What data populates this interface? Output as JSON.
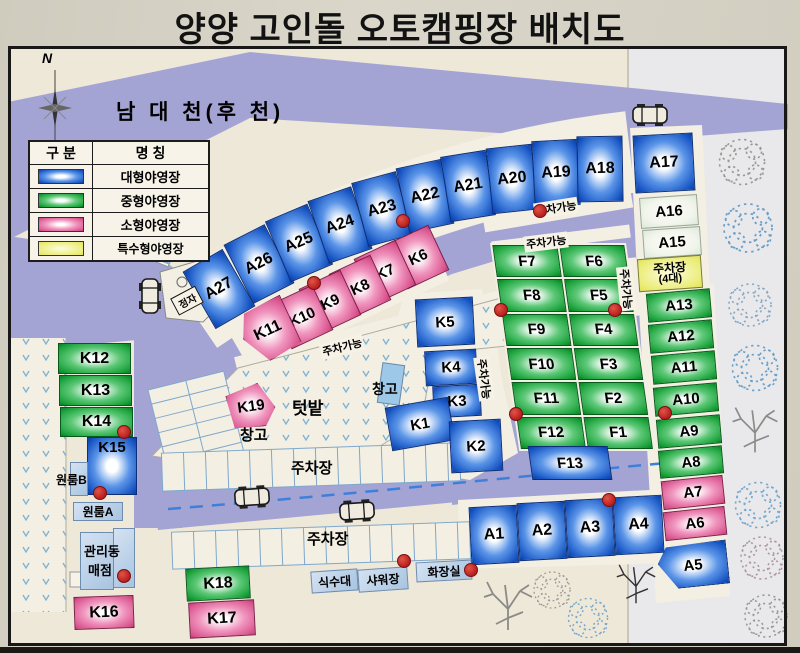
{
  "title": "양양 고인돌 오토캠핑장 배치도",
  "compass": "N",
  "river": "남 대 천(후 천)",
  "legend": {
    "col1": "구 분",
    "col2": "명 칭",
    "rows": [
      {
        "name": "대형야영장",
        "category": "large",
        "color": "#1553c2"
      },
      {
        "name": "중형야영장",
        "category": "medium",
        "color": "#17a038"
      },
      {
        "name": "소형야영장",
        "category": "small",
        "color": "#d9548e"
      },
      {
        "name": "특수형야영장",
        "category": "special",
        "color": "#e6e96e"
      }
    ]
  },
  "labels": {
    "stairs": "계단",
    "pavilion": "정자",
    "garden": "텃밭",
    "warehouse": "창고",
    "parking_lot": "주차장",
    "parking_ok": "주차가능",
    "parking4_line1": "주차장",
    "parking4_line2": "(4대)"
  },
  "facilities": {
    "water": "식수대",
    "shower": "샤워장",
    "toilet": "화장실",
    "admin": "관리동",
    "store": "매점",
    "oneroom_a": "원룸A",
    "oneroom_b": "원룸B"
  },
  "colors": {
    "river_road": "#a4a4d4",
    "red_dot": "#bf2020",
    "board": "#d5d1c4"
  },
  "sites": [
    {
      "id": "A27",
      "category": "large"
    },
    {
      "id": "A26",
      "category": "large"
    },
    {
      "id": "A25",
      "category": "large"
    },
    {
      "id": "A24",
      "category": "large"
    },
    {
      "id": "A23",
      "category": "large"
    },
    {
      "id": "A22",
      "category": "large"
    },
    {
      "id": "A21",
      "category": "large"
    },
    {
      "id": "A20",
      "category": "large"
    },
    {
      "id": "A19",
      "category": "large"
    },
    {
      "id": "A18",
      "category": "large"
    },
    {
      "id": "A17",
      "category": "large"
    },
    {
      "id": "A16",
      "category": "open"
    },
    {
      "id": "A15",
      "category": "open"
    },
    {
      "id": "A13",
      "category": "medium"
    },
    {
      "id": "A12",
      "category": "medium"
    },
    {
      "id": "A11",
      "category": "medium"
    },
    {
      "id": "A10",
      "category": "medium"
    },
    {
      "id": "A9",
      "category": "medium"
    },
    {
      "id": "A8",
      "category": "medium"
    },
    {
      "id": "A7",
      "category": "small"
    },
    {
      "id": "A6",
      "category": "small"
    },
    {
      "id": "A5",
      "category": "large"
    },
    {
      "id": "A1",
      "category": "large"
    },
    {
      "id": "A2",
      "category": "large"
    },
    {
      "id": "A3",
      "category": "large"
    },
    {
      "id": "A4",
      "category": "large"
    },
    {
      "id": "F7",
      "category": "medium"
    },
    {
      "id": "F6",
      "category": "medium"
    },
    {
      "id": "F8",
      "category": "medium"
    },
    {
      "id": "F5",
      "category": "medium"
    },
    {
      "id": "F9",
      "category": "medium"
    },
    {
      "id": "F4",
      "category": "medium"
    },
    {
      "id": "F10",
      "category": "medium"
    },
    {
      "id": "F3",
      "category": "medium"
    },
    {
      "id": "F11",
      "category": "medium"
    },
    {
      "id": "F2",
      "category": "medium"
    },
    {
      "id": "F12",
      "category": "medium"
    },
    {
      "id": "F1",
      "category": "medium"
    },
    {
      "id": "F13",
      "category": "large"
    },
    {
      "id": "K6",
      "category": "small"
    },
    {
      "id": "K7",
      "category": "small"
    },
    {
      "id": "K8",
      "category": "small"
    },
    {
      "id": "K9",
      "category": "small"
    },
    {
      "id": "K10",
      "category": "small"
    },
    {
      "id": "K11",
      "category": "small"
    },
    {
      "id": "K5",
      "category": "large"
    },
    {
      "id": "K4",
      "category": "large"
    },
    {
      "id": "K3",
      "category": "large"
    },
    {
      "id": "K1",
      "category": "large"
    },
    {
      "id": "K2",
      "category": "large"
    },
    {
      "id": "K19",
      "category": "small"
    },
    {
      "id": "K12",
      "category": "medium"
    },
    {
      "id": "K13",
      "category": "medium"
    },
    {
      "id": "K14",
      "category": "medium"
    },
    {
      "id": "K15",
      "category": "large"
    },
    {
      "id": "K16",
      "category": "small"
    },
    {
      "id": "K17",
      "category": "small"
    },
    {
      "id": "K18",
      "category": "medium"
    }
  ]
}
